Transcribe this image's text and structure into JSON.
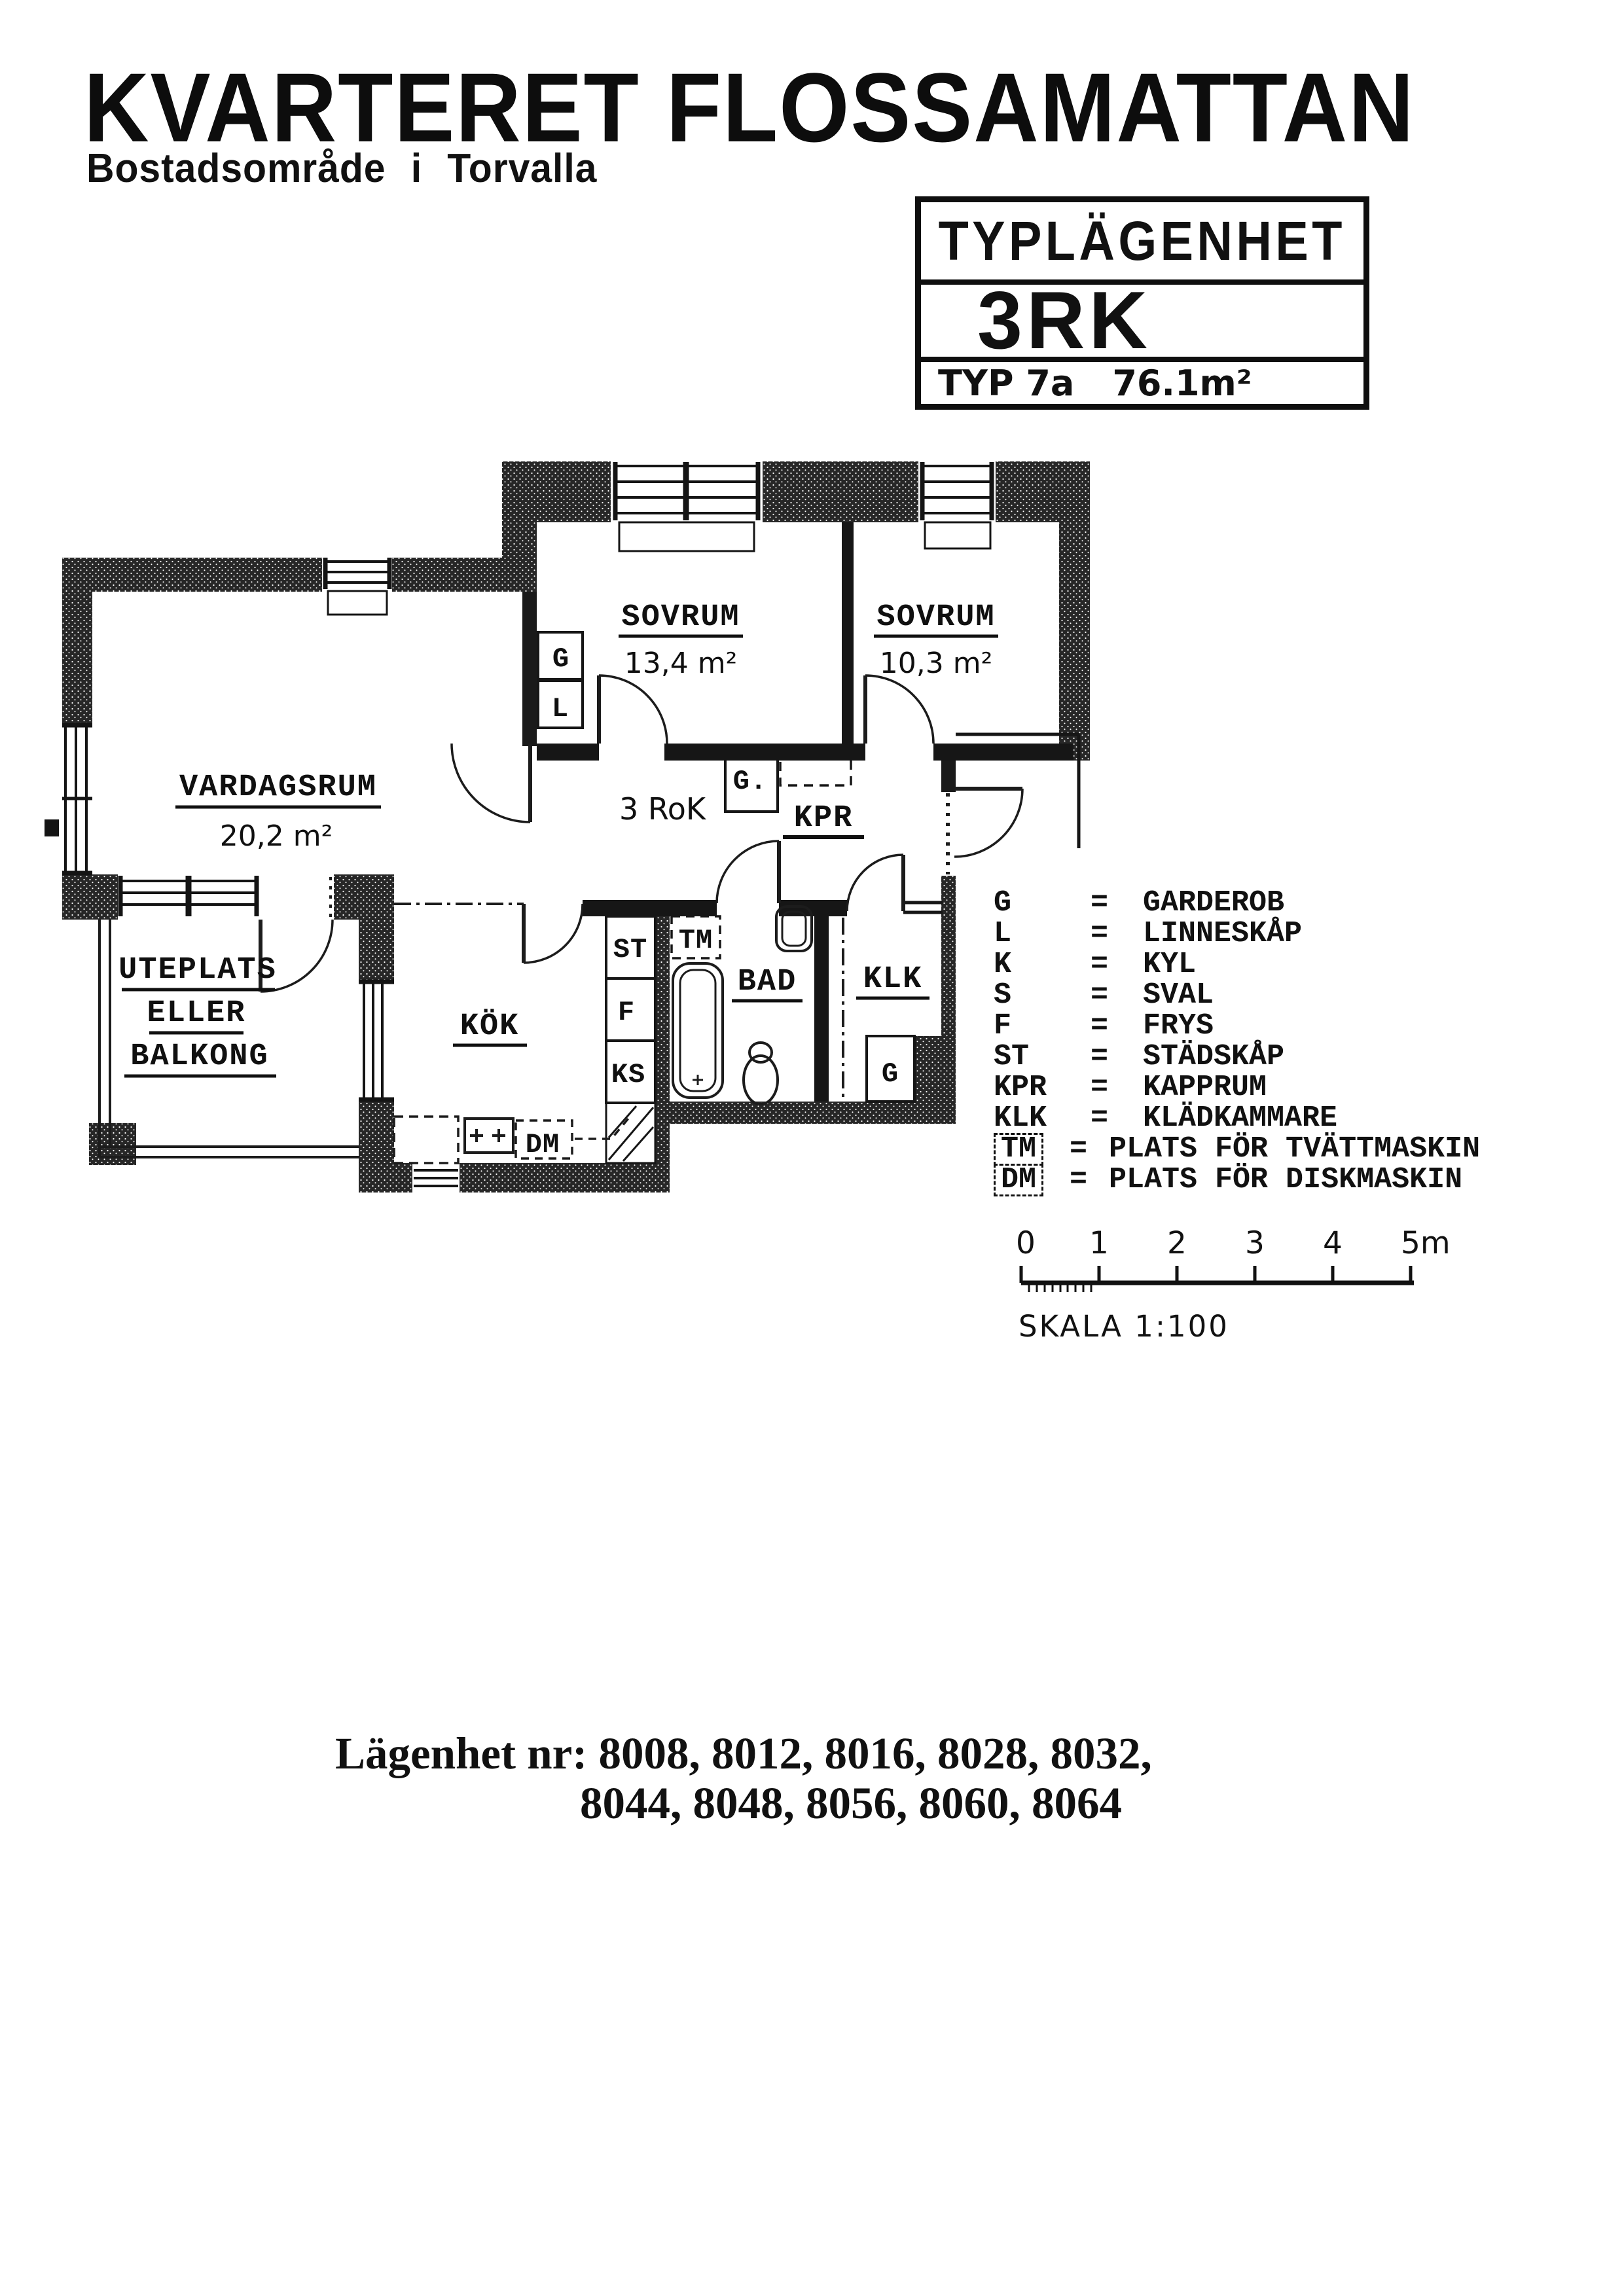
{
  "header": {
    "title": "KVARTERET FLOSSAMATTAN",
    "subtitle": "Bostadsområde i Torvalla"
  },
  "type_box": {
    "header": "TYPLÄGENHET",
    "size": "3RK",
    "type_label": "TYP 7a",
    "area": "76.1m²"
  },
  "plan": {
    "hall_label": "3 RoK",
    "rooms": {
      "sovrum1": {
        "name": "SOVRUM",
        "area": "13,4 m²"
      },
      "sovrum2": {
        "name": "SOVRUM",
        "area": "10,3 m²"
      },
      "vardagsrum": {
        "name": "VARDAGSRUM",
        "area": "20,2 m²"
      },
      "kok": {
        "name": "KÖK"
      },
      "bad": {
        "name": "BAD"
      },
      "klk": {
        "name": "KLK"
      },
      "kpr": {
        "name": "KPR"
      },
      "uteplats_line1": "UTEPLATS",
      "uteplats_line2": "ELLER",
      "uteplats_line3": "BALKONG"
    },
    "markers": {
      "g_bed": "G",
      "l_bed": "L",
      "g_hall": "G.",
      "st": "ST",
      "f": "F",
      "ks": "KS",
      "tm": "TM",
      "dm": "DM",
      "g_klk": "G"
    }
  },
  "legend": {
    "rows": [
      {
        "abbr": "G",
        "eq": "=",
        "text": "GARDEROB",
        "boxed": false
      },
      {
        "abbr": "L",
        "eq": "=",
        "text": "LINNESKÅP",
        "boxed": false
      },
      {
        "abbr": "K",
        "eq": "=",
        "text": "KYL",
        "boxed": false
      },
      {
        "abbr": "S",
        "eq": "=",
        "text": "SVAL",
        "boxed": false
      },
      {
        "abbr": "F",
        "eq": "=",
        "text": "FRYS",
        "boxed": false
      },
      {
        "abbr": "ST",
        "eq": "=",
        "text": "STÄDSKÅP",
        "boxed": false
      },
      {
        "abbr": "KPR",
        "eq": "=",
        "text": "KAPPRUM",
        "boxed": false
      },
      {
        "abbr": "KLK",
        "eq": "=",
        "text": "KLÄDKAMMARE",
        "boxed": false
      },
      {
        "abbr": "TM",
        "eq": "=",
        "text": "PLATS FÖR TVÄTTMASKIN",
        "boxed": true
      },
      {
        "abbr": "DM",
        "eq": "=",
        "text": "PLATS FÖR DISKMASKIN",
        "boxed": true
      }
    ]
  },
  "scale": {
    "ticks": [
      "0",
      "1",
      "2",
      "3",
      "4",
      "5m"
    ],
    "label": "SKALA 1:100"
  },
  "apartments": {
    "label": "Lägenhet nr:",
    "line1": "8008, 8012, 8016, 8028, 8032,",
    "line2": "8044, 8048, 8056, 8060, 8064"
  }
}
